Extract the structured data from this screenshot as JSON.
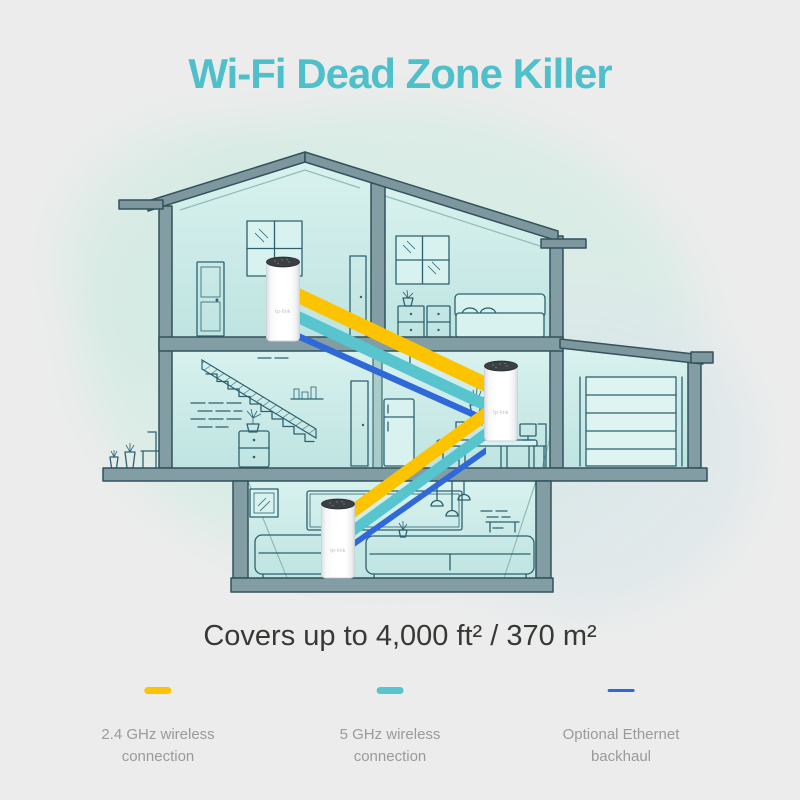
{
  "page": {
    "background": "#ececec"
  },
  "title": {
    "text": "Wi-Fi Dead Zone Killer",
    "color": "#4fc0ca"
  },
  "coverage": {
    "text": "Covers up to 4,000 ft² / 370 m²",
    "color": "#383835"
  },
  "legend": {
    "text_color": "#9a9a9a",
    "items": [
      {
        "id": "24ghz-wireless",
        "swatch_color": "#fcc400",
        "line1": "2.4 GHz wireless",
        "line2": "connection"
      },
      {
        "id": "5ghz-wireless",
        "swatch_color": "#57c4ce",
        "line1": "5 GHz wireless",
        "line2": "connection"
      },
      {
        "id": "ethernet-backhaul",
        "swatch_color": "#2f68d8",
        "line1": "Optional Ethernet",
        "line2": "backhaul"
      }
    ]
  },
  "device": {
    "logo": "tp-link"
  },
  "colors": {
    "beam_24ghz": "#fcc400",
    "beam_5ghz": "#57c4ce",
    "beam_ethernet": "#2f68d8",
    "house_structure": "#829da4",
    "house_roof": "#7e969e",
    "house_lineart": "#2c6270",
    "room_fill": "#c0e5e2",
    "background_blob": "#d7ece5"
  }
}
